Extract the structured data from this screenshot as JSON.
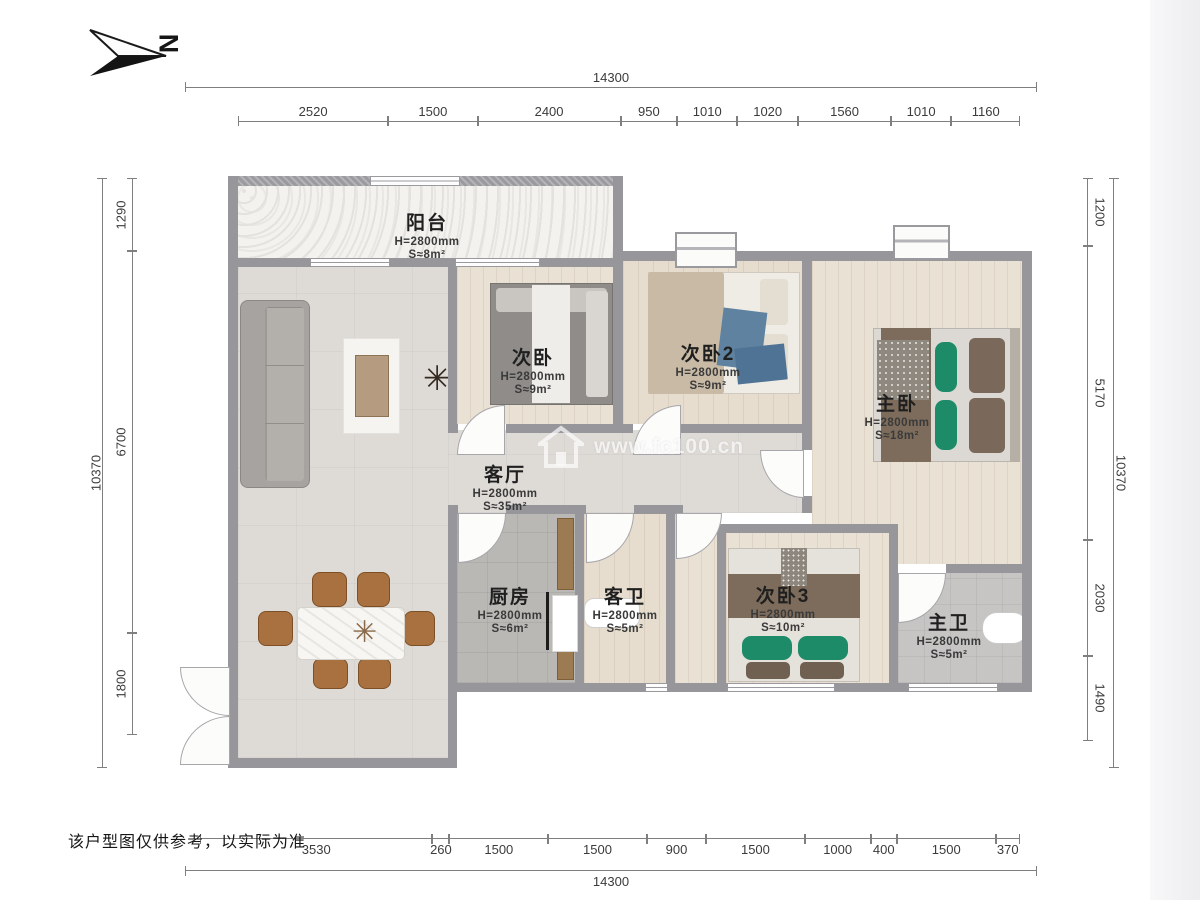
{
  "compass": {
    "label": "N"
  },
  "disclaimer": "该户型图仅供参考，以实际为准",
  "watermark": {
    "site": "www.fc100.cn",
    "logo": "house-icon"
  },
  "palette": {
    "wall": "#97969a",
    "wood_floor": "#e9e1d3",
    "tile_floor": "#dedbd7",
    "kitchen_floor": "#b9b8b5",
    "bath_floor": "#c6c5c4",
    "accent_green": "#1d8a68",
    "chair_brown": "#a9713f",
    "dim_text": "#3b3b3b"
  },
  "dimensions": {
    "top": {
      "total": "14300",
      "segments": [
        "2520",
        "1500",
        "2400",
        "950",
        "1010",
        "1020",
        "1560",
        "1010",
        "1160"
      ]
    },
    "bottom": {
      "total": "14300",
      "segments": [
        "3530",
        "260",
        "1500",
        "1500",
        "900",
        "1500",
        "1000",
        "400",
        "1500",
        "370"
      ]
    },
    "left": {
      "total": "10370",
      "segments": [
        "1290",
        "6700",
        "1800"
      ]
    },
    "right": {
      "total": "10370",
      "segments": [
        "1200",
        "5170",
        "2030",
        "1490"
      ]
    }
  },
  "rooms": [
    {
      "key": "balcony",
      "name": "阳台",
      "height": "H=2800mm",
      "area": "S≈8m²"
    },
    {
      "key": "bedroom-2",
      "name": "次卧",
      "height": "H=2800mm",
      "area": "S≈9m²"
    },
    {
      "key": "bedroom-2b",
      "name": "次卧2",
      "height": "H=2800mm",
      "area": "S≈9m²"
    },
    {
      "key": "master-bedroom",
      "name": "主卧",
      "height": "H=2800mm",
      "area": "S≈18m²"
    },
    {
      "key": "living-room",
      "name": "客厅",
      "height": "H=2800mm",
      "area": "S≈35m²"
    },
    {
      "key": "kitchen",
      "name": "厨房",
      "height": "H=2800mm",
      "area": "S≈6m²"
    },
    {
      "key": "guest-bathroom",
      "name": "客卫",
      "height": "H=2800mm",
      "area": "S≈5m²"
    },
    {
      "key": "bedroom-3",
      "name": "次卧3",
      "height": "H=2800mm",
      "area": "S≈10m²"
    },
    {
      "key": "master-bathroom",
      "name": "主卫",
      "height": "H=2800mm",
      "area": "S≈5m²"
    }
  ]
}
